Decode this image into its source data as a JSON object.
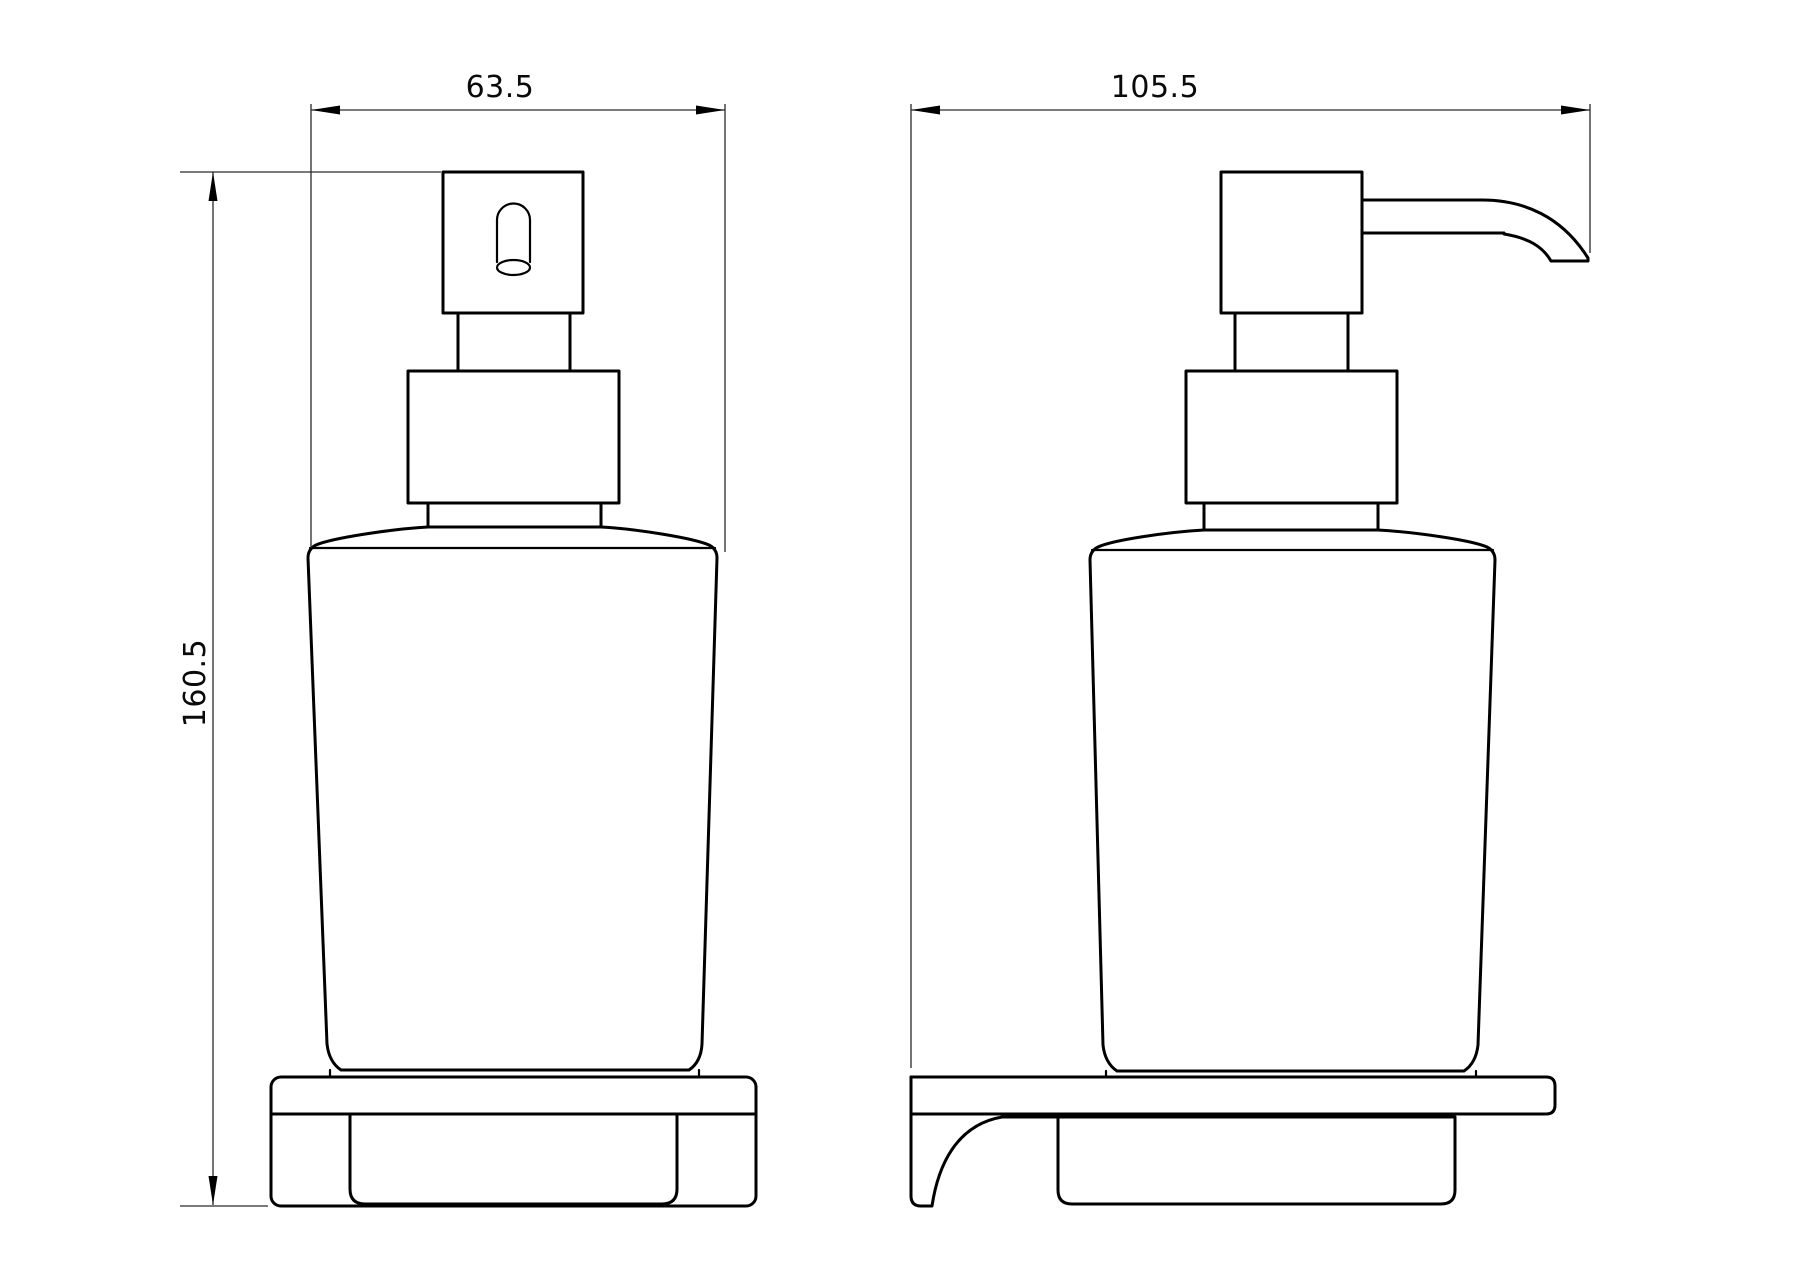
{
  "drawing": {
    "type": "technical-drawing",
    "product": "wall-mounted-soap-dispenser",
    "views": {
      "front": {
        "name": "front-view",
        "width_dimension": "63.5",
        "height_dimension": "160.5"
      },
      "side": {
        "name": "side-view",
        "depth_dimension": "105.5"
      }
    },
    "colors": {
      "background": "#ffffff",
      "object_line": "#000000",
      "dimension_line": "#2a2a2a",
      "text": "#0a0a0a"
    }
  }
}
